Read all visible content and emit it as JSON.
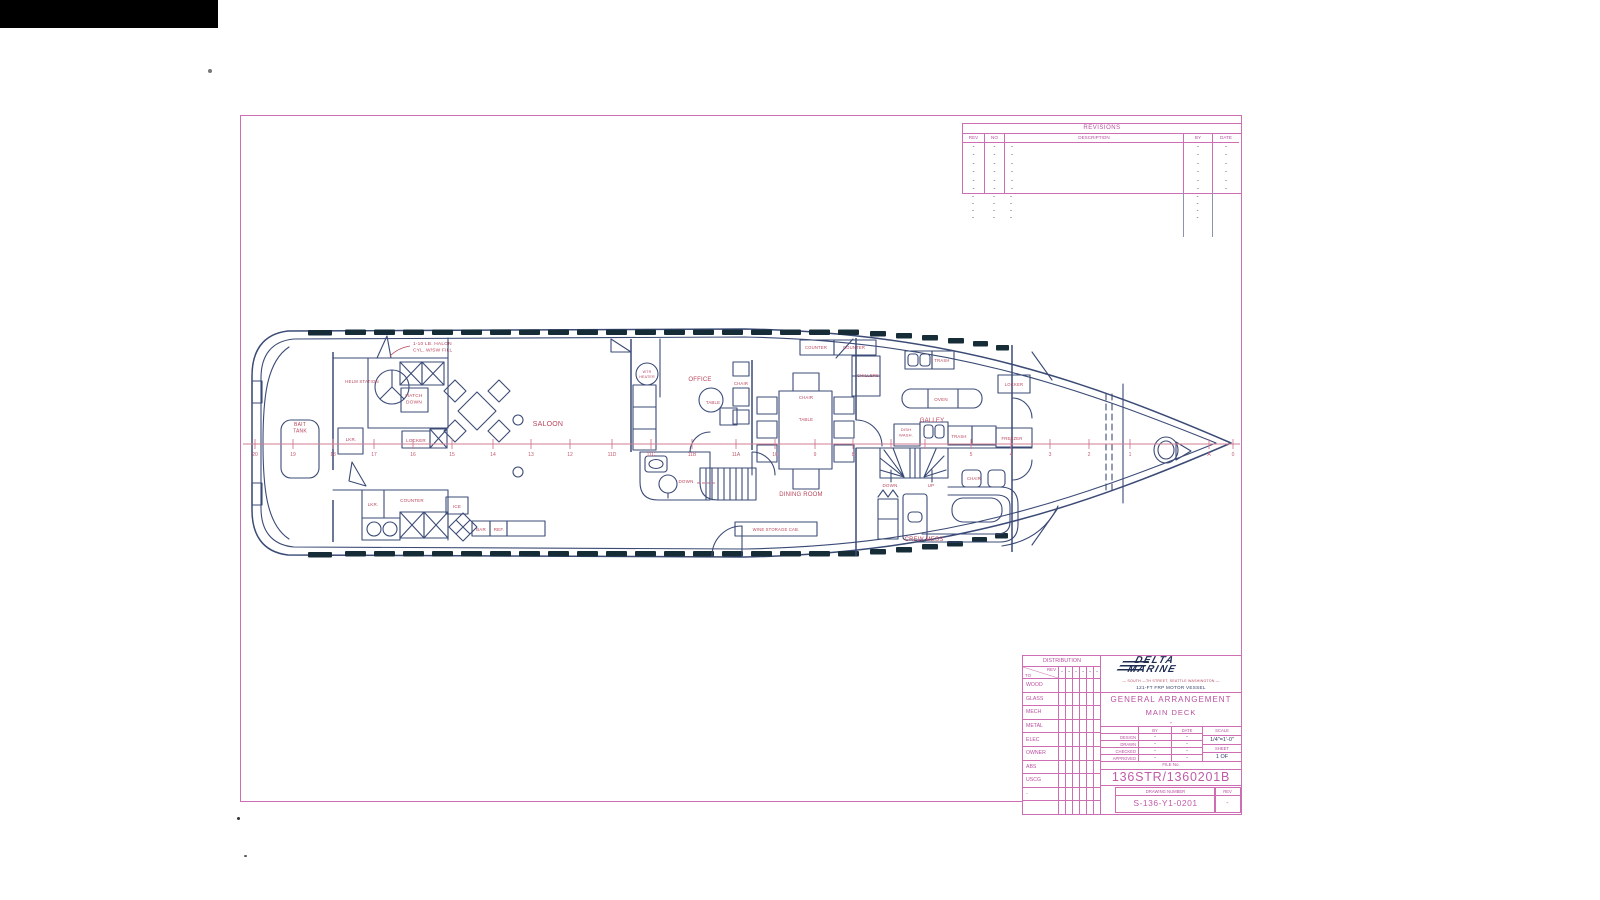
{
  "colors": {
    "sheet_border": "#cf6db3",
    "pink_text": "#bb4fa0",
    "navy": "#2e3d66",
    "red_label": "#b8455c",
    "line": "#3b4b76",
    "window": "#162d38",
    "centerline": "#d07d92"
  },
  "revisions": {
    "title": "REVISIONS",
    "columns": [
      "REV",
      "NO",
      "DESCRIPTION",
      "BY",
      "DATE"
    ],
    "dash": "-",
    "bordered_row_count": 6,
    "overflow_row_count": 4
  },
  "title_block": {
    "distribution": {
      "title": "DISTRIBUTION",
      "to_label": "TO",
      "rev_label": "REV",
      "dash": "-",
      "rows": [
        "WOOD",
        "GLASS",
        "MECH",
        "METAL",
        "ELEC",
        "OWNER",
        "ABS",
        "USCG",
        "-",
        ""
      ]
    },
    "logo_line1": "DELTA",
    "logo_line2": "MARINE",
    "address": "— SOUTH —TH STREET, SEATTLE WASHINGTON —",
    "vessel": "121-FT FRP MOTOR VESSEL",
    "title1": "GENERAL ARRANGEMENT",
    "title2": "MAIN DECK",
    "title3": "-",
    "signoff": {
      "by_label": "BY",
      "date_label": "DATE",
      "scale_label": "SCALE",
      "rows": [
        [
          "DESIGN",
          "-",
          "-"
        ],
        [
          "DRAWN",
          "-",
          "-"
        ],
        [
          "CHECKED",
          "-",
          "-"
        ],
        [
          "APPROVED",
          "-",
          "-"
        ]
      ],
      "scale_value": "1/4\"=1'-0\"",
      "sheet_label": "SHEET",
      "sheet_value": "1 OF"
    },
    "file_label": "FILE No.",
    "file_number": "136STR/1360201B",
    "drawing_number_label": "DRAWING NUMBER",
    "drawing_number": "S-136-Y1-0201",
    "rev_label": "REV",
    "rev_value": "-"
  },
  "plan": {
    "centerline_y": 444,
    "frames": [
      [
        "20",
        255
      ],
      [
        "19",
        293
      ],
      [
        "18",
        333
      ],
      [
        "17",
        374
      ],
      [
        "16",
        413
      ],
      [
        "15",
        452
      ],
      [
        "14",
        493
      ],
      [
        "13",
        531
      ],
      [
        "12",
        570
      ],
      [
        "11D",
        612
      ],
      [
        "11C",
        651
      ],
      [
        "11B",
        692
      ],
      [
        "11A",
        736
      ],
      [
        "10",
        775
      ],
      [
        "9",
        815
      ],
      [
        "8",
        853
      ],
      [
        "5",
        971
      ],
      [
        "4",
        1011
      ],
      [
        "3",
        1050
      ],
      [
        "2",
        1089
      ],
      [
        "1",
        1130
      ],
      [
        "A",
        1209
      ],
      [
        "0",
        1233
      ]
    ],
    "extra_ticks": [
      891,
      925
    ],
    "labels": [
      {
        "lines": [
          "1-10 LB. HALON",
          "CYL. W/SW FILL"
        ],
        "x": 413,
        "y": 345,
        "size": 4.8,
        "anchor": "start"
      },
      {
        "lines": [
          "HELM STATION"
        ],
        "x": 362,
        "y": 383,
        "size": 4.3
      },
      {
        "lines": [
          "HATCH",
          "DOWN"
        ],
        "x": 414,
        "y": 397,
        "size": 4.8
      },
      {
        "lines": [
          "BAIT",
          "TANK"
        ],
        "x": 300,
        "y": 426,
        "size": 5
      },
      {
        "lines": [
          "LKR."
        ],
        "x": 351,
        "y": 441,
        "size": 4.5
      },
      {
        "lines": [
          "LOCKER"
        ],
        "x": 416,
        "y": 442,
        "size": 4.5
      },
      {
        "lines": [
          "LKR."
        ],
        "x": 373,
        "y": 506,
        "size": 4.5
      },
      {
        "lines": [
          "COUNTER"
        ],
        "x": 412,
        "y": 502,
        "size": 4.5
      },
      {
        "lines": [
          "ICE"
        ],
        "x": 457,
        "y": 508,
        "size": 4.5
      },
      {
        "lines": [
          "BAR"
        ],
        "x": 481,
        "y": 531,
        "size": 4.5
      },
      {
        "lines": [
          "REF."
        ],
        "x": 499,
        "y": 531,
        "size": 4.5
      },
      {
        "lines": [
          "SALOON"
        ],
        "x": 548,
        "y": 426,
        "size": 7
      },
      {
        "lines": [
          "WTR",
          "HEATER"
        ],
        "x": 647,
        "y": 373,
        "size": 3.6
      },
      {
        "lines": [
          "OFFICE"
        ],
        "x": 700,
        "y": 381,
        "size": 6
      },
      {
        "lines": [
          "TABLE"
        ],
        "x": 713,
        "y": 404,
        "size": 4.3
      },
      {
        "lines": [
          "CHAIR"
        ],
        "x": 741,
        "y": 385,
        "size": 4.3
      },
      {
        "lines": [
          "CHAIR"
        ],
        "x": 806,
        "y": 399,
        "size": 4.3
      },
      {
        "lines": [
          "TABLE"
        ],
        "x": 806,
        "y": 421,
        "size": 4.3
      },
      {
        "lines": [
          "DOWN"
        ],
        "x": 686,
        "y": 483,
        "size": 4.5
      },
      {
        "lines": [
          "DINING ROOM"
        ],
        "x": 801,
        "y": 496,
        "size": 6
      },
      {
        "lines": [
          "WINE STORAGE CAB."
        ],
        "x": 776,
        "y": 531,
        "size": 4.2
      },
      {
        "lines": [
          "COUNTER"
        ],
        "x": 816,
        "y": 349,
        "size": 4.2
      },
      {
        "lines": [
          "COUNTER"
        ],
        "x": 854,
        "y": 349,
        "size": 4.2
      },
      {
        "lines": [
          "CHILLERS"
        ],
        "x": 868,
        "y": 377,
        "size": 4.2
      },
      {
        "lines": [
          "TRASH"
        ],
        "x": 942,
        "y": 362,
        "size": 4.2
      },
      {
        "lines": [
          "OVEN"
        ],
        "x": 941,
        "y": 401,
        "size": 4.5
      },
      {
        "lines": [
          "GALLEY"
        ],
        "x": 932,
        "y": 422,
        "size": 6
      },
      {
        "lines": [
          "DISH",
          "WASH."
        ],
        "x": 906,
        "y": 431,
        "size": 4
      },
      {
        "lines": [
          "TRASH"
        ],
        "x": 959,
        "y": 438,
        "size": 4.2
      },
      {
        "lines": [
          "LOCKER"
        ],
        "x": 1014,
        "y": 386,
        "size": 4.2
      },
      {
        "lines": [
          "FREEZER"
        ],
        "x": 1012,
        "y": 440,
        "size": 4.2
      },
      {
        "lines": [
          "DOWN"
        ],
        "x": 890,
        "y": 487,
        "size": 4.5
      },
      {
        "lines": [
          "UP"
        ],
        "x": 931,
        "y": 487,
        "size": 4.5
      },
      {
        "lines": [
          "CHAIR"
        ],
        "x": 974,
        "y": 480,
        "size": 4.2
      },
      {
        "lines": [
          "CREW MESS"
        ],
        "x": 924,
        "y": 541,
        "size": 6
      }
    ]
  }
}
